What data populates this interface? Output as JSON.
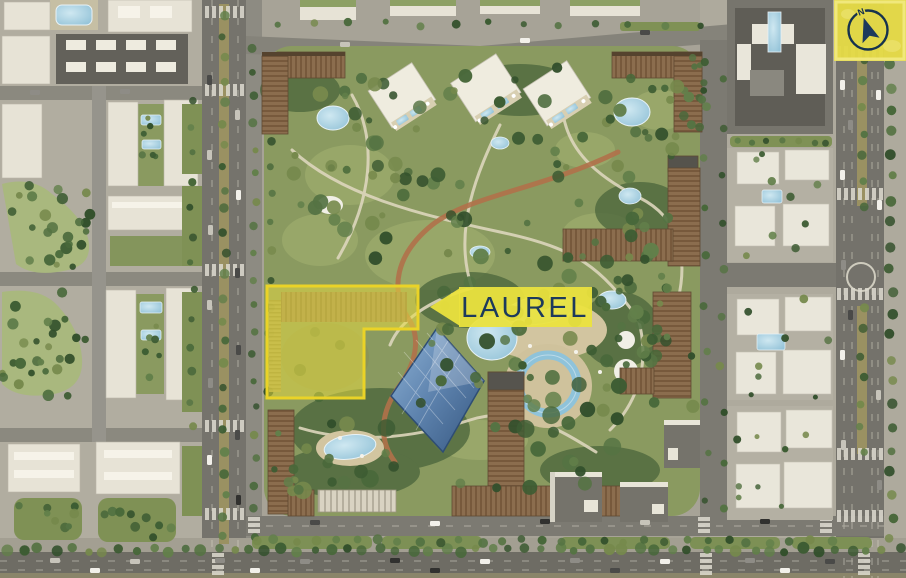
{
  "map": {
    "name": "masterplan-aerial-view",
    "plot_label": "LAUREL",
    "compass_north": "N",
    "colors": {
      "highlight_yellow": "#EADF3F",
      "highlight_border": "#EAD327",
      "label_navy": "#1D3A5C",
      "park_green": "#8A9A60",
      "building_brown": "#8B6D4E",
      "pool_blue": "#9EC9DC",
      "road_gray": "#75736C"
    }
  }
}
